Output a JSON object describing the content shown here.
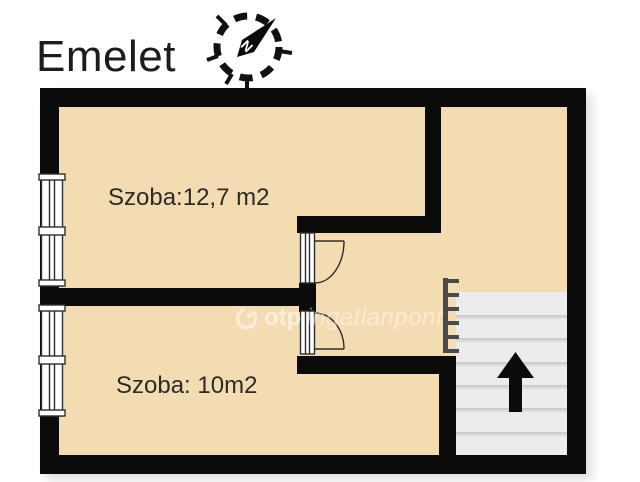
{
  "page": {
    "title": "Emelet"
  },
  "compass": {
    "north_label": "N"
  },
  "rooms": [
    {
      "label": "Szoba:12,7 m2"
    },
    {
      "label": "Szoba: 10m2"
    }
  ],
  "stairs": {
    "direction": "up",
    "tread_count": 7
  },
  "watermark": {
    "brand": "otp",
    "suffix": "ingatlanpont"
  },
  "colors": {
    "floor": "#f3dcb1",
    "wall": "#0b0b0b",
    "stairs-bg": "#ececec",
    "tread-line": "#c6c6c6",
    "railing": "#4a4a4a",
    "label-text": "#2b2b2b",
    "title-text": "#1c1c1c",
    "symbol-stroke": "#2e2e2e",
    "watermark-color": "#ffffff",
    "page-bg": "#ffffff"
  }
}
